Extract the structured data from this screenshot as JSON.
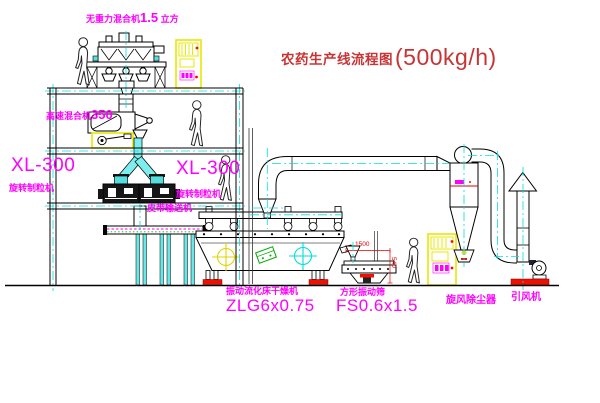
{
  "title": {
    "text": "农药生产线流程图",
    "capacity": "(500kg/h)"
  },
  "labels": {
    "zero_gravity_mixer": {
      "name": "无重力混合机",
      "size": "1.5",
      "unit": "立方"
    },
    "high_speed_mixer": {
      "name": "高速混合机",
      "size": "350"
    },
    "granulator_left": {
      "model": "XL-300",
      "name": "旋转制粒机"
    },
    "granulator_right": {
      "model": "XL-300",
      "name": "旋转制粒机"
    },
    "belt_conveyor": "皮带输送机",
    "fluid_bed_dryer": {
      "name": "振动流化床干燥机",
      "model": "ZLG6x0.75"
    },
    "vibrating_screen": {
      "name": "方形振动筛",
      "model": "FS0.6x1.5"
    },
    "cyclone": "旋风除尘器",
    "draft_fan": "引风机"
  },
  "dimensions": {
    "width": "1500",
    "height": "540"
  },
  "colors": {
    "label_magenta": "#ff00ff",
    "title_red": "#cc3434",
    "centerline_cyan": "#00e0e0",
    "pipe_cyan": "#7deded",
    "cabinet_yellow": "#e8e800",
    "accent_red": "#ee1100",
    "accent_green": "#00aa00",
    "line_black": "#000000"
  }
}
